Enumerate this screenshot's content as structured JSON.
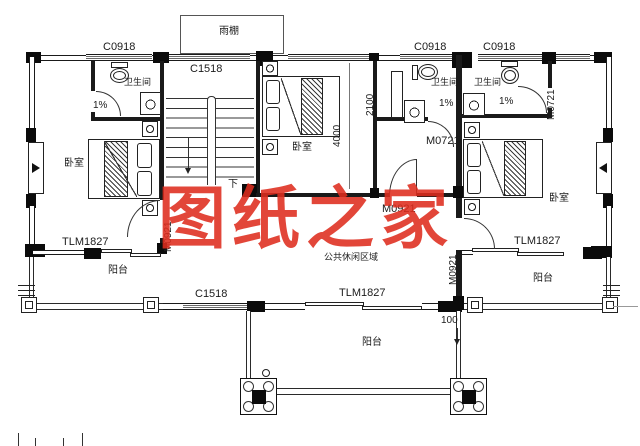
{
  "document": {
    "kind": "architectural-floor-plan",
    "watermark": {
      "text": "图纸之家",
      "color": "#DE2C1E"
    }
  },
  "rooms": {
    "bedroom": "卧室",
    "bathroom": "卫生间",
    "balcony": "阳台",
    "public_lounge": "公共休闲区域",
    "rain_canopy": "雨棚"
  },
  "openings": {
    "c0918": "C0918",
    "c1518": "C1518",
    "tlm1827": "TLM1827",
    "m0921": "M0921",
    "m0721": "M0721"
  },
  "dimensions": {
    "bedroom_depth": "4000",
    "bath_depth": "2100",
    "offset": "100"
  },
  "annotations": {
    "floor_slope": "1%",
    "stair_down": "下"
  }
}
